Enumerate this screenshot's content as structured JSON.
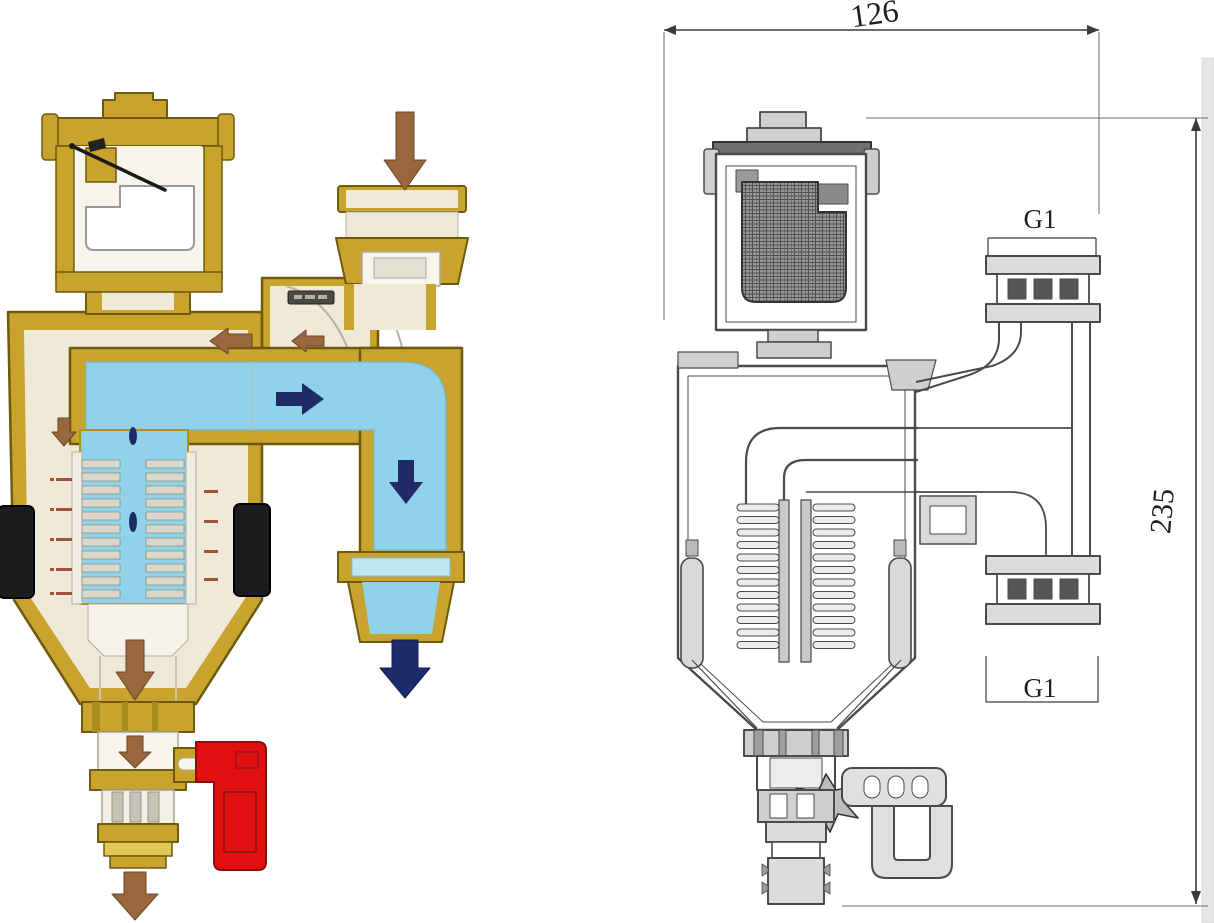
{
  "canvas": {
    "background": "#ffffff"
  },
  "cutaway": {
    "colors": {
      "brass": "#c8a32d",
      "brass_dark_outline": "#6f5a0b",
      "brass_light": "#e4c855",
      "interior_cream": "#f0e9d8",
      "water_blue": "#8fd2e9",
      "water_arrow_navy": "#202a66",
      "air_arrow_brown": "#98673c",
      "magnet_black": "#1c1c1c",
      "drain_handle_red": "#e01010"
    }
  },
  "drawing": {
    "stroke_gray": "#4a4a4a",
    "fill_gray": "#d9d9d9",
    "dimensions": {
      "overall_width": "126",
      "overall_height": "235",
      "inlet_thread": "G1",
      "outlet_thread": "G1"
    }
  }
}
